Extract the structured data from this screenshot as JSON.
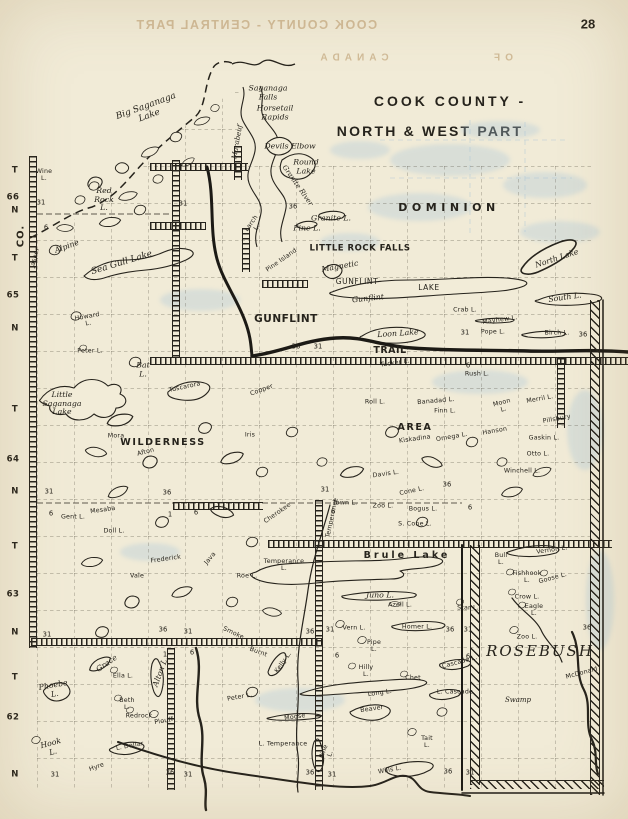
{
  "page": {
    "number": "28"
  },
  "bleed": {
    "line1": "COOK COUNTY - CENTRAL PART",
    "word_canada": "CANADA",
    "word_of": "OF"
  },
  "title": {
    "line1": "COOK COUNTY -",
    "line2": "NORTH & WEST PART"
  },
  "labels": [
    {
      "t": "T",
      "x": 15,
      "y": 171,
      "c": "m"
    },
    {
      "t": "66",
      "x": 13,
      "y": 198,
      "c": "m"
    },
    {
      "t": "N",
      "x": 15,
      "y": 211,
      "c": "m"
    },
    {
      "t": "CO.",
      "x": 21,
      "y": 236,
      "c": "mco",
      "r": -90
    },
    {
      "t": "T",
      "x": 15,
      "y": 259,
      "c": "m"
    },
    {
      "t": "65",
      "x": 13,
      "y": 296,
      "c": "m"
    },
    {
      "t": "N",
      "x": 15,
      "y": 329,
      "c": "m"
    },
    {
      "t": "T",
      "x": 15,
      "y": 410,
      "c": "m"
    },
    {
      "t": "64",
      "x": 13,
      "y": 460,
      "c": "m"
    },
    {
      "t": "N",
      "x": 15,
      "y": 492,
      "c": "m"
    },
    {
      "t": "T",
      "x": 15,
      "y": 547,
      "c": "m"
    },
    {
      "t": "63",
      "x": 13,
      "y": 595,
      "c": "m"
    },
    {
      "t": "N",
      "x": 15,
      "y": 633,
      "c": "m"
    },
    {
      "t": "T",
      "x": 15,
      "y": 678,
      "c": "m"
    },
    {
      "t": "62",
      "x": 13,
      "y": 718,
      "c": "m"
    },
    {
      "t": "N",
      "x": 15,
      "y": 775,
      "c": "m"
    },
    {
      "t": "DOMINION",
      "x": 449,
      "y": 208,
      "c": "reg"
    },
    {
      "t": "LITTLE ROCK FALLS",
      "x": 360,
      "y": 249,
      "c": "b8"
    },
    {
      "t": "GUNFLINT",
      "x": 357,
      "y": 282,
      "c": "prt"
    },
    {
      "t": "LAKE",
      "x": 429,
      "y": 288,
      "c": "prt"
    },
    {
      "t": "GUNFLINT",
      "x": 286,
      "y": 320,
      "c": "b10"
    },
    {
      "t": "TRAIL",
      "x": 390,
      "y": 351,
      "c": "b9"
    },
    {
      "t": "WILDERNESS",
      "x": 163,
      "y": 443,
      "c": "reg2"
    },
    {
      "t": "AREA",
      "x": 415,
      "y": 428,
      "c": "reg2"
    },
    {
      "t": "Brule  Lake",
      "x": 407,
      "y": 556,
      "c": "b9",
      "ls": 3
    },
    {
      "t": "ROSEBUSH",
      "x": 540,
      "y": 651,
      "c": "rose"
    },
    {
      "t": "Big Saganaga\nLake",
      "x": 148,
      "y": 112,
      "c": "c9",
      "r": -20
    },
    {
      "t": "Saganaga\nFalls",
      "x": 268,
      "y": 93,
      "c": "c8"
    },
    {
      "t": "Horsetail\nRapids",
      "x": 275,
      "y": 113,
      "c": "c8"
    },
    {
      "t": "Devils Elbow",
      "x": 290,
      "y": 147,
      "c": "c8"
    },
    {
      "t": "Round\nLake",
      "x": 306,
      "y": 167,
      "c": "c8"
    },
    {
      "t": "Granite River",
      "x": 297,
      "y": 186,
      "c": "c7",
      "r": 55
    },
    {
      "t": "Marabeuf",
      "x": 238,
      "y": 142,
      "c": "c7",
      "r": -80
    },
    {
      "t": "Granite L.",
      "x": 331,
      "y": 219,
      "c": "c8"
    },
    {
      "t": "Pine L.",
      "x": 307,
      "y": 229,
      "c": "c8"
    },
    {
      "t": "Larch\nL.",
      "x": 255,
      "y": 226,
      "c": "s6",
      "r": -55
    },
    {
      "t": "Pine Island",
      "x": 282,
      "y": 261,
      "c": "s6",
      "r": -35
    },
    {
      "t": "Magnetic",
      "x": 340,
      "y": 267,
      "c": "c8",
      "r": -10
    },
    {
      "t": "Gunflint",
      "x": 368,
      "y": 299,
      "c": "c8",
      "r": -6
    },
    {
      "t": "Loon Lake",
      "x": 398,
      "y": 334,
      "c": "c8",
      "r": -4
    },
    {
      "t": "North Lake",
      "x": 557,
      "y": 259,
      "c": "c8",
      "r": -18
    },
    {
      "t": "South L.",
      "x": 565,
      "y": 298,
      "c": "c8",
      "r": -8
    },
    {
      "t": "Crab L.",
      "x": 465,
      "y": 311,
      "c": "s6"
    },
    {
      "t": "Mayhew L.",
      "x": 500,
      "y": 321,
      "c": "s6",
      "r": -8
    },
    {
      "t": "Pope L.",
      "x": 493,
      "y": 333,
      "c": "s6"
    },
    {
      "t": "Birch L.",
      "x": 557,
      "y": 334,
      "c": "s6"
    },
    {
      "t": "Wine\nL.",
      "x": 44,
      "y": 176,
      "c": "s6"
    },
    {
      "t": "Red\nRock\nL.",
      "x": 104,
      "y": 200,
      "c": "c8"
    },
    {
      "t": "Alpine",
      "x": 67,
      "y": 247,
      "c": "c8",
      "r": -20
    },
    {
      "t": "Sea Gull Lake",
      "x": 122,
      "y": 264,
      "c": "c9",
      "r": -17
    },
    {
      "t": "Jasper",
      "x": 36,
      "y": 258,
      "c": "s6",
      "r": -75
    },
    {
      "t": "Howard\nL.",
      "x": 88,
      "y": 321,
      "c": "s6",
      "r": -10
    },
    {
      "t": "Peter L.",
      "x": 90,
      "y": 352,
      "c": "s6"
    },
    {
      "t": "Bat\nL.",
      "x": 143,
      "y": 370,
      "c": "c8"
    },
    {
      "t": "Little\nSaganaga\nLake",
      "x": 62,
      "y": 404,
      "c": "c8"
    },
    {
      "t": "Tuscarora",
      "x": 185,
      "y": 388,
      "c": "s6",
      "r": -12
    },
    {
      "t": "Copper",
      "x": 262,
      "y": 391,
      "c": "s6",
      "r": -20
    },
    {
      "t": "Iris",
      "x": 250,
      "y": 436,
      "c": "s6"
    },
    {
      "t": "Mora",
      "x": 116,
      "y": 437,
      "c": "s6"
    },
    {
      "t": "Afton",
      "x": 146,
      "y": 453,
      "c": "s6",
      "r": -15
    },
    {
      "t": "Gent L.",
      "x": 73,
      "y": 518,
      "c": "s6"
    },
    {
      "t": "Mesaba",
      "x": 103,
      "y": 511,
      "c": "s6",
      "r": -8
    },
    {
      "t": "Doll L.",
      "x": 114,
      "y": 532,
      "c": "s6"
    },
    {
      "t": "Frederick",
      "x": 166,
      "y": 560,
      "c": "s6",
      "r": -8
    },
    {
      "t": "Vale",
      "x": 137,
      "y": 577,
      "c": "s6"
    },
    {
      "t": "Java",
      "x": 211,
      "y": 559,
      "c": "s6",
      "r": -50
    },
    {
      "t": "Roe L.",
      "x": 247,
      "y": 577,
      "c": "s6"
    },
    {
      "t": "Rush L.",
      "x": 477,
      "y": 375,
      "c": "s6"
    },
    {
      "t": "Tucker L.",
      "x": 395,
      "y": 364,
      "c": "s6",
      "r": -8
    },
    {
      "t": "Roll L.",
      "x": 375,
      "y": 403,
      "c": "s6"
    },
    {
      "t": "Banadad L.",
      "x": 436,
      "y": 402,
      "c": "s6",
      "r": -5
    },
    {
      "t": "Finn L.",
      "x": 445,
      "y": 412,
      "c": "s6"
    },
    {
      "t": "Moon\nL.",
      "x": 503,
      "y": 407,
      "c": "s6",
      "r": -15
    },
    {
      "t": "Merril L.",
      "x": 540,
      "y": 400,
      "c": "s6",
      "r": -10
    },
    {
      "t": "Pillsbury",
      "x": 557,
      "y": 420,
      "c": "s6",
      "r": -10
    },
    {
      "t": "Hanson",
      "x": 495,
      "y": 432,
      "c": "s6",
      "r": -10
    },
    {
      "t": "Gaskin L.",
      "x": 544,
      "y": 439,
      "c": "s6"
    },
    {
      "t": "Kiskadina",
      "x": 415,
      "y": 440,
      "c": "s6",
      "r": -8
    },
    {
      "t": "Omega L.",
      "x": 452,
      "y": 438,
      "c": "s6",
      "r": -10
    },
    {
      "t": "Otto L.",
      "x": 538,
      "y": 455,
      "c": "s6"
    },
    {
      "t": "Winchell L.",
      "x": 522,
      "y": 472,
      "c": "s6"
    },
    {
      "t": "Davis L.",
      "x": 386,
      "y": 475,
      "c": "s6",
      "r": -8
    },
    {
      "t": "Cone L.",
      "x": 412,
      "y": 492,
      "c": "s6",
      "r": -12
    },
    {
      "t": "Town L.",
      "x": 345,
      "y": 504,
      "c": "s6"
    },
    {
      "t": "Zoo L.",
      "x": 383,
      "y": 507,
      "c": "s6"
    },
    {
      "t": "Bogus L.",
      "x": 423,
      "y": 510,
      "c": "s6"
    },
    {
      "t": "S. Cone L.",
      "x": 415,
      "y": 525,
      "c": "s6"
    },
    {
      "t": "Cherokee",
      "x": 278,
      "y": 514,
      "c": "s6",
      "r": -35
    },
    {
      "t": "Temperance",
      "x": 333,
      "y": 518,
      "c": "s6",
      "r": -78
    },
    {
      "t": "Temperance\nL.",
      "x": 284,
      "y": 566,
      "c": "s6"
    },
    {
      "t": "Juno L.",
      "x": 380,
      "y": 596,
      "c": "c8"
    },
    {
      "t": "Azell L.",
      "x": 400,
      "y": 606,
      "c": "s6"
    },
    {
      "t": "Homer L.",
      "x": 417,
      "y": 628,
      "c": "s6"
    },
    {
      "t": "Vern L.",
      "x": 354,
      "y": 629,
      "c": "s6"
    },
    {
      "t": "Pipe\nL.",
      "x": 374,
      "y": 647,
      "c": "s6"
    },
    {
      "t": "Star L.",
      "x": 468,
      "y": 609,
      "c": "s6"
    },
    {
      "t": "Vernon L.",
      "x": 552,
      "y": 551,
      "c": "s6",
      "r": -8
    },
    {
      "t": "Bull\nL.",
      "x": 501,
      "y": 560,
      "c": "s6"
    },
    {
      "t": "Fishhook\nL.",
      "x": 527,
      "y": 578,
      "c": "s6"
    },
    {
      "t": "Goose L.",
      "x": 553,
      "y": 579,
      "c": "s6",
      "r": -15
    },
    {
      "t": "Crow L.",
      "x": 527,
      "y": 598,
      "c": "s6"
    },
    {
      "t": "Eagle\nL.",
      "x": 534,
      "y": 611,
      "c": "s6"
    },
    {
      "t": "Zoo L.",
      "x": 527,
      "y": 638,
      "c": "s6"
    },
    {
      "t": "McDonald",
      "x": 582,
      "y": 674,
      "c": "s6",
      "r": -15
    },
    {
      "t": "Swamp",
      "x": 518,
      "y": 701,
      "c": "c7"
    },
    {
      "t": "Phoebe\nL.",
      "x": 54,
      "y": 690,
      "c": "c8",
      "r": -10
    },
    {
      "t": "Grace",
      "x": 107,
      "y": 664,
      "c": "c8",
      "r": -35
    },
    {
      "t": "Ella L.",
      "x": 123,
      "y": 677,
      "c": "s6"
    },
    {
      "t": "Beth\nL.",
      "x": 127,
      "y": 705,
      "c": "s6"
    },
    {
      "t": "Alton L.",
      "x": 161,
      "y": 672,
      "c": "c8",
      "r": -70
    },
    {
      "t": "Redrock",
      "x": 139,
      "y": 717,
      "c": "s6"
    },
    {
      "t": "Plouff",
      "x": 164,
      "y": 722,
      "c": "s6",
      "r": -10
    },
    {
      "t": "L. Dollar",
      "x": 130,
      "y": 747,
      "c": "s6",
      "r": -10
    },
    {
      "t": "Hook\nL.",
      "x": 52,
      "y": 748,
      "c": "c8",
      "r": -15
    },
    {
      "t": "Hyre",
      "x": 97,
      "y": 768,
      "c": "s6",
      "r": -20
    },
    {
      "t": "Kelly L.",
      "x": 284,
      "y": 663,
      "c": "s6",
      "r": -55
    },
    {
      "t": "Smoke",
      "x": 233,
      "y": 634,
      "c": "s6",
      "r": 25
    },
    {
      "t": "Burnt",
      "x": 258,
      "y": 653,
      "c": "s6",
      "r": 20
    },
    {
      "t": "Peter L.",
      "x": 240,
      "y": 698,
      "c": "s6",
      "r": -10
    },
    {
      "t": "Hilly\nL.",
      "x": 366,
      "y": 672,
      "c": "s6"
    },
    {
      "t": "Long L.",
      "x": 380,
      "y": 694,
      "c": "s6",
      "r": -8
    },
    {
      "t": "Chet",
      "x": 413,
      "y": 679,
      "c": "s6"
    },
    {
      "t": "Cascade L.",
      "x": 460,
      "y": 663,
      "c": "s6",
      "r": -15
    },
    {
      "t": "L. Cascade",
      "x": 455,
      "y": 693,
      "c": "s6"
    },
    {
      "t": "Beaver",
      "x": 372,
      "y": 710,
      "c": "s6",
      "r": -8
    },
    {
      "t": "Moose",
      "x": 295,
      "y": 718,
      "c": "s6",
      "r": -8
    },
    {
      "t": "Pine\nL.",
      "x": 328,
      "y": 753,
      "c": "s6",
      "r": -70
    },
    {
      "t": "Tait\nL.",
      "x": 427,
      "y": 743,
      "c": "s6"
    },
    {
      "t": "Wills L.",
      "x": 390,
      "y": 771,
      "c": "s6",
      "r": -10
    },
    {
      "t": "L. Temperance",
      "x": 283,
      "y": 745,
      "c": "s6"
    },
    {
      "t": "31",
      "x": 41,
      "y": 203,
      "c": "n"
    },
    {
      "t": "6",
      "x": 46,
      "y": 228,
      "c": "n"
    },
    {
      "t": "31",
      "x": 183,
      "y": 204,
      "c": "n"
    },
    {
      "t": "36",
      "x": 293,
      "y": 207,
      "c": "n"
    },
    {
      "t": "36",
      "x": 296,
      "y": 347,
      "c": "n"
    },
    {
      "t": "31",
      "x": 318,
      "y": 347,
      "c": "n"
    },
    {
      "t": "31",
      "x": 465,
      "y": 333,
      "c": "n"
    },
    {
      "t": "36",
      "x": 583,
      "y": 335,
      "c": "n"
    },
    {
      "t": "6",
      "x": 468,
      "y": 366,
      "c": "n"
    },
    {
      "t": "31",
      "x": 49,
      "y": 492,
      "c": "n"
    },
    {
      "t": "6",
      "x": 51,
      "y": 514,
      "c": "n"
    },
    {
      "t": "36",
      "x": 167,
      "y": 493,
      "c": "n"
    },
    {
      "t": "1",
      "x": 170,
      "y": 515,
      "c": "n"
    },
    {
      "t": "6",
      "x": 196,
      "y": 513,
      "c": "n"
    },
    {
      "t": "31",
      "x": 325,
      "y": 490,
      "c": "n"
    },
    {
      "t": "36",
      "x": 447,
      "y": 485,
      "c": "n"
    },
    {
      "t": "6",
      "x": 333,
      "y": 512,
      "c": "n"
    },
    {
      "t": "6",
      "x": 470,
      "y": 508,
      "c": "n"
    },
    {
      "t": "31",
      "x": 47,
      "y": 635,
      "c": "n"
    },
    {
      "t": "36",
      "x": 163,
      "y": 630,
      "c": "n"
    },
    {
      "t": "31",
      "x": 188,
      "y": 632,
      "c": "n"
    },
    {
      "t": "1",
      "x": 165,
      "y": 655,
      "c": "n"
    },
    {
      "t": "6",
      "x": 192,
      "y": 653,
      "c": "n"
    },
    {
      "t": "36",
      "x": 310,
      "y": 632,
      "c": "n"
    },
    {
      "t": "31",
      "x": 330,
      "y": 630,
      "c": "n"
    },
    {
      "t": "6",
      "x": 337,
      "y": 656,
      "c": "n"
    },
    {
      "t": "36",
      "x": 450,
      "y": 630,
      "c": "n"
    },
    {
      "t": "31",
      "x": 468,
      "y": 630,
      "c": "n"
    },
    {
      "t": "6",
      "x": 468,
      "y": 657,
      "c": "n"
    },
    {
      "t": "36",
      "x": 587,
      "y": 628,
      "c": "n"
    },
    {
      "t": "31",
      "x": 55,
      "y": 775,
      "c": "n"
    },
    {
      "t": "36",
      "x": 170,
      "y": 773,
      "c": "n"
    },
    {
      "t": "31",
      "x": 188,
      "y": 775,
      "c": "n"
    },
    {
      "t": "36",
      "x": 310,
      "y": 773,
      "c": "n"
    },
    {
      "t": "31",
      "x": 332,
      "y": 775,
      "c": "n"
    },
    {
      "t": "36",
      "x": 448,
      "y": 772,
      "c": "n"
    },
    {
      "t": "31",
      "x": 470,
      "y": 773,
      "c": "n"
    }
  ]
}
